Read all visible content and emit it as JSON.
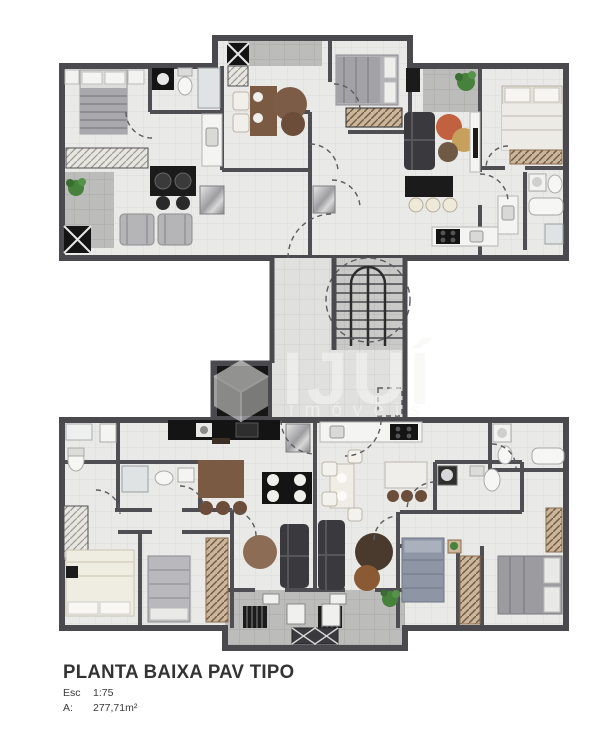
{
  "title_block": {
    "title": "PLANTA BAIXA PAV TIPO",
    "scale_label": "Esc",
    "scale_value": "1:75",
    "area_label": "A:",
    "area_value": "277,71m²"
  },
  "watermark": {
    "brand": "IJUÍ",
    "subtitle": "imóveis",
    "logo": "cube-logo",
    "color": "#f5f5f3",
    "opacity": 0.55
  },
  "plan": {
    "kind": "residential-floor-plan-typical-floor",
    "scale": "1:75",
    "total_area": "277,71m²",
    "blocks": [
      {
        "name": "upper-wing",
        "apartments": [
          {
            "name": "apt-top-left",
            "rooms": [
              "bedroom",
              "bathroom",
              "kitchen",
              "living-dining",
              "balcony"
            ]
          },
          {
            "name": "apt-top-middle",
            "rooms": [
              "bedroom",
              "dining",
              "living",
              "kitchen",
              "balcony"
            ]
          },
          {
            "name": "apt-top-right",
            "rooms": [
              "bedroom",
              "bathroom",
              "kitchen-living",
              "balcony"
            ]
          }
        ]
      },
      {
        "name": "central-core",
        "features": [
          "staircase",
          "elevator",
          "corridor",
          "landing"
        ]
      },
      {
        "name": "lower-wing",
        "apartments": [
          {
            "name": "apt-bottom-left",
            "rooms": [
              "bedroom-1",
              "bedroom-2",
              "bathroom-1",
              "bathroom-2",
              "kitchen",
              "living-dining",
              "service-balcony"
            ]
          },
          {
            "name": "apt-bottom-right",
            "rooms": [
              "bedroom-1",
              "bedroom-2",
              "bathroom-1",
              "bathroom-2",
              "kitchen",
              "living-dining",
              "service-balcony"
            ]
          }
        ]
      }
    ]
  },
  "colors": {
    "wall": "#4f4f53",
    "floor": "#e9e9e7",
    "floor_grid": "#dbdbd8",
    "balcony": "#bcbcba",
    "stair_floor": "#c9c9c7",
    "furniture_black": "#1b1b1b",
    "wood_brown": "#7b5a44",
    "accent_tan": "#c98a5a",
    "sofa_dark": "#3a3a3e",
    "plant_green": "#47823c",
    "text": "#333333"
  }
}
